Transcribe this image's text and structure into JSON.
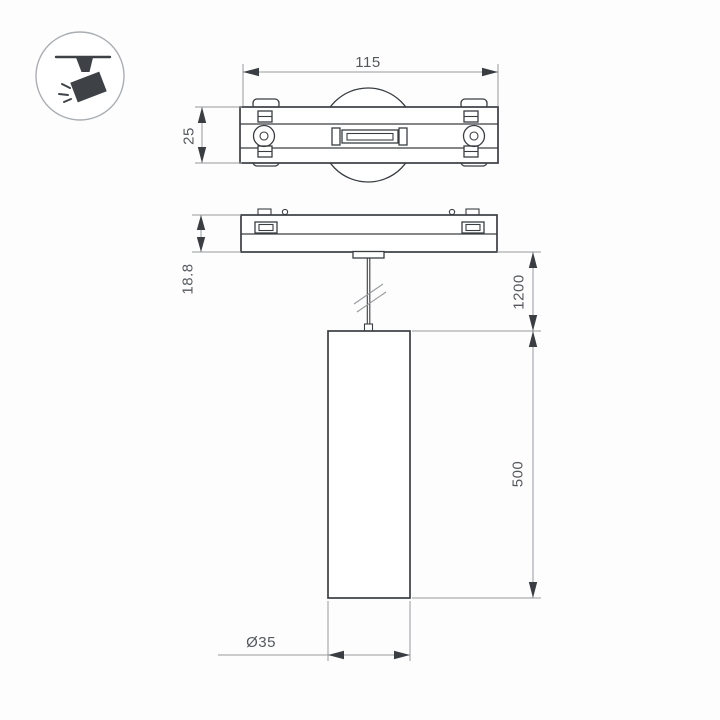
{
  "labels": {
    "track_length": "115",
    "track_width": "25",
    "track_height": "18.8",
    "suspension_length": "1200",
    "pendant_height": "500",
    "pendant_diameter": "Ø35"
  },
  "icon": {
    "name": "track-spotlight-icon"
  },
  "colors": {
    "line": "#3a3e42",
    "dim": "#96999c",
    "text": "#55595d",
    "icon": "#3e4247",
    "bg": "#fdfdfd"
  }
}
